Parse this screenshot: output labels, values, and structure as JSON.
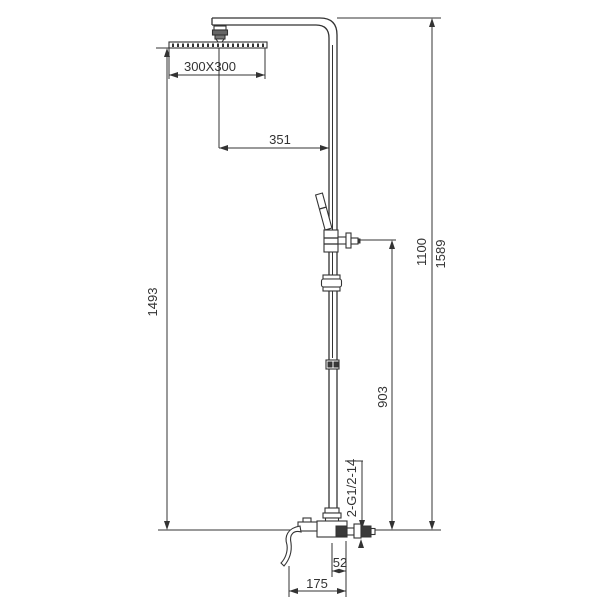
{
  "drawing": {
    "kind": "technical-dimension-drawing",
    "background": "#ffffff",
    "line_color": "#333333",
    "dimensions": {
      "head_size": "300X300",
      "head_arm_offset": "351",
      "left_overall_height": "1493",
      "bracket_height": "903",
      "handshower_height": "1100",
      "overall_height": "1589",
      "inlet_thread": "2-G1/2-14",
      "pipe_wall_offset": "52",
      "spout_projection": "175"
    }
  }
}
